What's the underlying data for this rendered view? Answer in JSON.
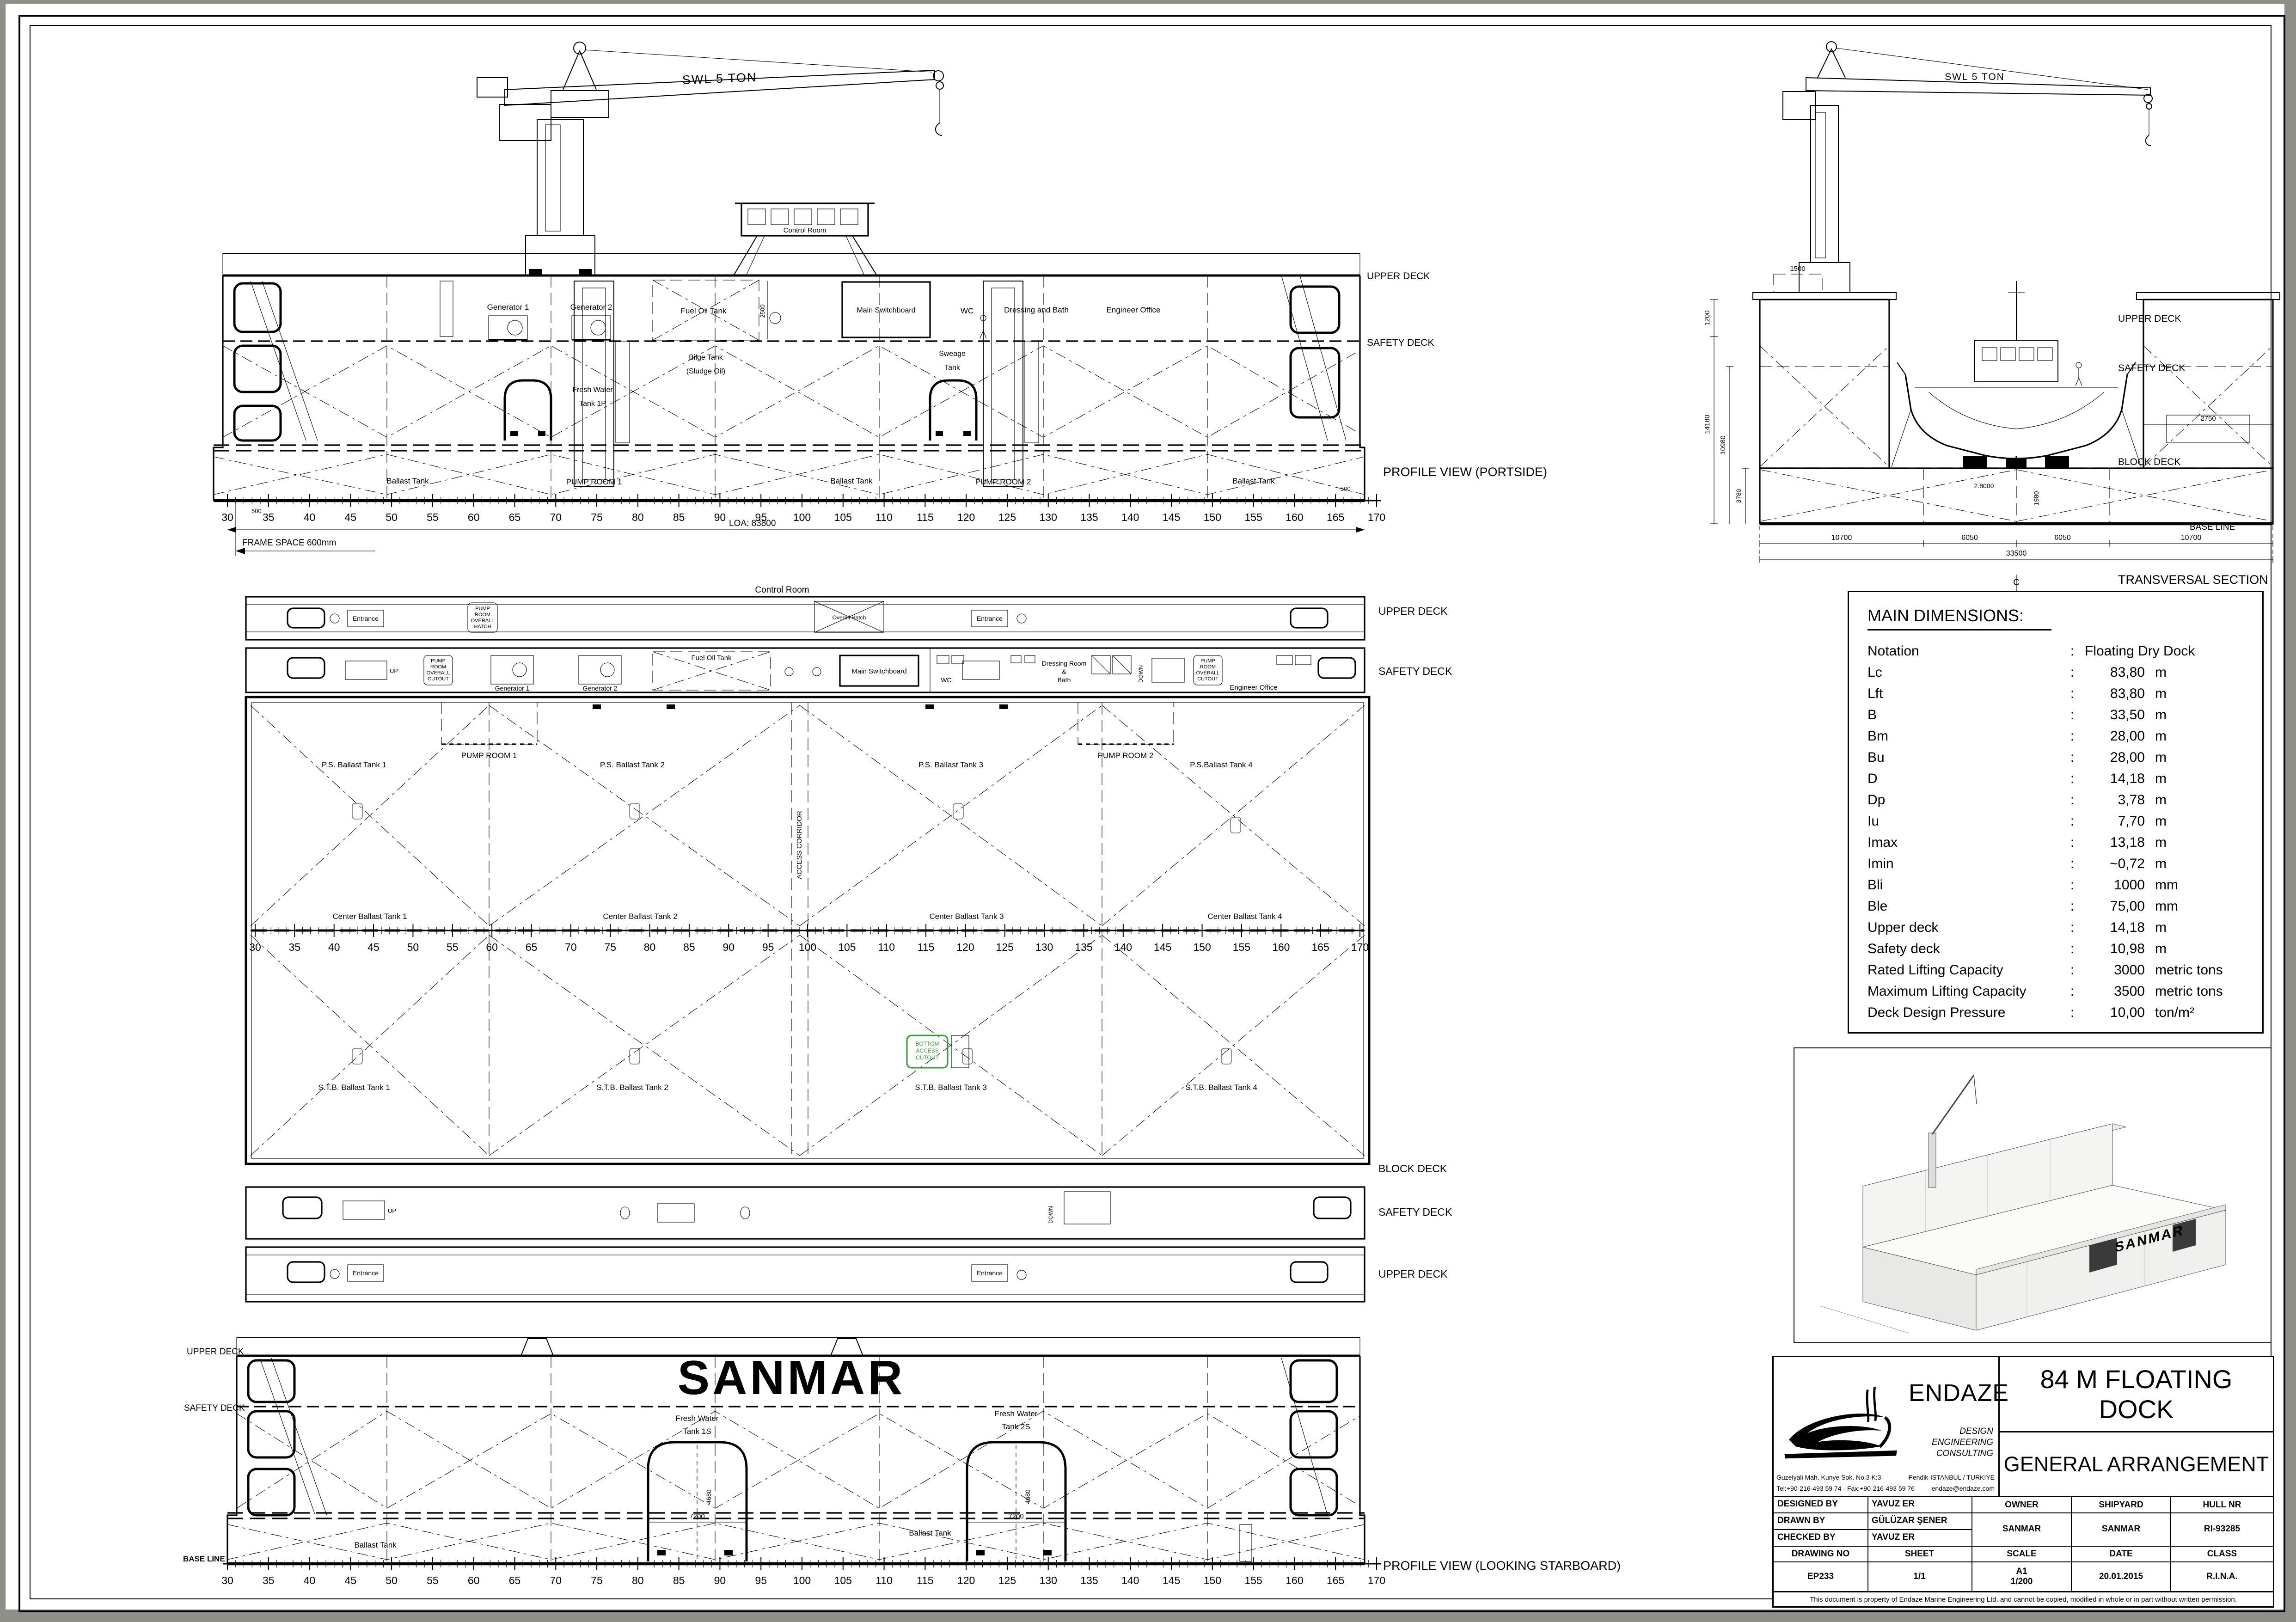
{
  "colors": {
    "ink": "#000000",
    "paper": "#ffffff",
    "highlight": "#2f9e2f"
  },
  "frames": [
    "30",
    "35",
    "40",
    "45",
    "50",
    "55",
    "60",
    "65",
    "70",
    "75",
    "80",
    "85",
    "90",
    "95",
    "100",
    "105",
    "110",
    "115",
    "120",
    "125",
    "130",
    "135",
    "140",
    "145",
    "150",
    "155",
    "160",
    "165",
    "170"
  ],
  "profile_portside": {
    "caption": "PROFILE VIEW (PORTSIDE)",
    "swl": "SWL 5 TON",
    "control_room": "Control Room",
    "upper_deck": "UPPER DECK",
    "safety_deck": "SAFETY DECK",
    "generator1": "Generator 1",
    "generator2": "Generator 2",
    "fuel_oil_tank": "Fuel Oil Tank",
    "dim_2500": "2500",
    "bilge1": "Bilge Tank",
    "bilge2": "(Sludge Oil)",
    "fresh1": "Fresh Water",
    "fresh2": "Tank 1P",
    "sweage1": "Sweage",
    "sweage2": "Tank",
    "main_switchboard": "Main Switchboard",
    "wc": "WC",
    "dressing": "Dressing and Bath",
    "engineer_office": "Engineer Office",
    "ballast_1": "Ballast Tank",
    "pump_room_1": "PUMP ROOM 1",
    "ballast_2": "Ballast Tank",
    "pump_room_2": "PUMP ROOM 2",
    "ballast_3": "Ballast Tank",
    "dim_500_left": "500",
    "dim_500_right": "500",
    "loa": "LOA: 83800",
    "frame_space": "FRAME SPACE 600mm"
  },
  "transversal": {
    "caption": "TRANSVERSAL SECTION",
    "swl": "SWL 5 TON",
    "upper_deck": "UPPER DECK",
    "safety_deck": "SAFETY DECK",
    "block_deck": "BLOCK DECK",
    "base_line": "BASE LINE",
    "cl_c": "C",
    "cl_l": "L",
    "dim_1500": "1500",
    "dim_1200": "1200",
    "dim_14180": "14180",
    "dim_10980": "10980",
    "dim_3780": "3780",
    "dim_2750": "2750",
    "dim_2800": "2.8000",
    "dim_1980": "1980",
    "dim_10700_l": "10700",
    "dim_6050_l": "6050",
    "dim_6050_r": "6050",
    "dim_10700_r": "10700",
    "dim_33500": "33500"
  },
  "main_dimensions": {
    "title": "MAIN DIMENSIONS:",
    "rows": [
      [
        "Notation",
        "Floating Dry Dock",
        ""
      ],
      [
        "Lc",
        "83,80",
        "m"
      ],
      [
        "Lft",
        "83,80",
        "m"
      ],
      [
        "B",
        "33,50",
        "m"
      ],
      [
        "Bm",
        "28,00",
        "m"
      ],
      [
        "Bu",
        "28,00",
        "m"
      ],
      [
        "D",
        "14,18",
        "m"
      ],
      [
        "Dp",
        "3,78",
        "m"
      ],
      [
        "Iu",
        "7,70",
        "m"
      ],
      [
        "Imax",
        "13,18",
        "m"
      ],
      [
        "Imin",
        "~0,72",
        "m"
      ],
      [
        "Bli",
        "1000",
        "mm"
      ],
      [
        "Ble",
        "75,00",
        "mm"
      ],
      [
        "Upper deck",
        "14,18",
        "m"
      ],
      [
        "Safety deck",
        "10,98",
        "m"
      ],
      [
        "Rated Lifting Capacity",
        "3000",
        "metric tons"
      ],
      [
        "Maximum Lifting Capacity",
        "3500",
        "metric tons"
      ],
      [
        "Deck Design Pressure",
        "10,00",
        "ton/m²"
      ]
    ]
  },
  "plans": {
    "upper_deck_top": "UPPER DECK",
    "safety_deck_top": "SAFETY DECK",
    "block_deck": "BLOCK DECK",
    "safety_deck_bottom": "SAFETY DECK",
    "upper_deck_bottom": "UPPER DECK",
    "control_room": "Control Room",
    "entrance": "Entrance",
    "overall_hatch": "Overall Hatch",
    "pr_hatch": [
      "PUMP",
      "ROOM",
      "OVERALL",
      "HATCH"
    ],
    "pr_cutout": [
      "PUMP",
      "ROOM",
      "OVERALL",
      "CUTOUT"
    ],
    "bottom_cutout": [
      "BOTTOM",
      "ACCESS",
      "CUTOUT"
    ],
    "up": "UP",
    "down": "DOWN",
    "generator1": "Generator 1",
    "generator2": "Generator 2",
    "fuel_oil_tank": "Fuel Oil Tank",
    "main_switchboard": "Main Switchboard",
    "wc": "WC",
    "dressing1": "Dressing Room",
    "dressing2": "&",
    "dressing3": "Bath",
    "engineer_office": "Engineer Office",
    "pump_room_1": "PUMP ROOM 1",
    "pump_room_2": "PUMP ROOM 2",
    "access_corridor": "ACCESS CORRIDOR",
    "ps_tanks": [
      "P.S. Ballast Tank 1",
      "P.S. Ballast Tank 2",
      "P.S. Ballast Tank 3",
      "P.S.Ballast Tank 4"
    ],
    "center_tanks": [
      "Center Ballast Tank 1",
      "Center Ballast Tank 2",
      "Center Ballast Tank 3",
      "Center Ballast Tank 4"
    ],
    "stb_tanks": [
      "S.T.B. Ballast Tank 1",
      "S.T.B. Ballast Tank 2",
      "S.T.B. Ballast Tank 3",
      "S.T.B. Ballast Tank 4"
    ]
  },
  "profile_starboard": {
    "caption": "PROFILE VIEW (LOOKING STARBOARD)",
    "brand": "SANMAR",
    "upper_deck": "UPPER DECK",
    "safety_deck": "SAFETY DECK",
    "base_line": "BASE LINE",
    "fw1a": "Fresh Water",
    "fw1b": "Tank 1S",
    "fw2a": "Fresh Water",
    "fw2b": "Tank 2S",
    "ballast_a": "Ballast Tank",
    "ballast_b": "Ballast Tank",
    "dim_7200_1": "7200",
    "dim_4680_1": "4680",
    "dim_7200_2": "7200",
    "dim_4680_2": "4680"
  },
  "perspective": {
    "brand": "SANMAR"
  },
  "title_block": {
    "company": "ENDAZE",
    "tagline1": "DESIGN",
    "tagline2": "ENGINEERING",
    "tagline3": "CONSULTING",
    "addr1": "Guzelyali Mah. Kunye Sok. No:3 K:3",
    "addr2": "Tel:+90-216-493 59 74 - Fax:+90-216-493 59 76",
    "addr3": "Pendik-ISTANBUL / TURKIYE",
    "addr4": "endaze@endaze.com",
    "project": "84 M FLOATING DOCK",
    "drawing_title": "GENERAL ARRANGEMENT",
    "h_designed": "DESIGNED BY",
    "v_designed": "YAVUZ ER",
    "h_drawn": "DRAWN BY",
    "v_drawn": "GÜLÜZAR ŞENER",
    "h_checked": "CHECKED BY",
    "v_checked": "YAVUZ ER",
    "h_owner": "OWNER",
    "v_owner": "SANMAR",
    "h_shipyard": "SHIPYARD",
    "v_shipyard": "SANMAR",
    "h_hull": "HULL NR",
    "v_hull": "RI-93285",
    "h_drawing_no": "DRAWING NO",
    "v_drawing_no": "EP233",
    "h_sheet": "SHEET",
    "v_sheet": "1/1",
    "h_scale": "SCALE",
    "v_scale_1": "A1",
    "v_scale_2": "1/200",
    "h_date": "DATE",
    "v_date": "20.01.2015",
    "h_class": "CLASS",
    "v_class": "R.I.N.A.",
    "disclaimer": "This document is property of Endaze Marine Engineering Ltd. and cannot be copied, modified in whole or in part without written permission."
  }
}
